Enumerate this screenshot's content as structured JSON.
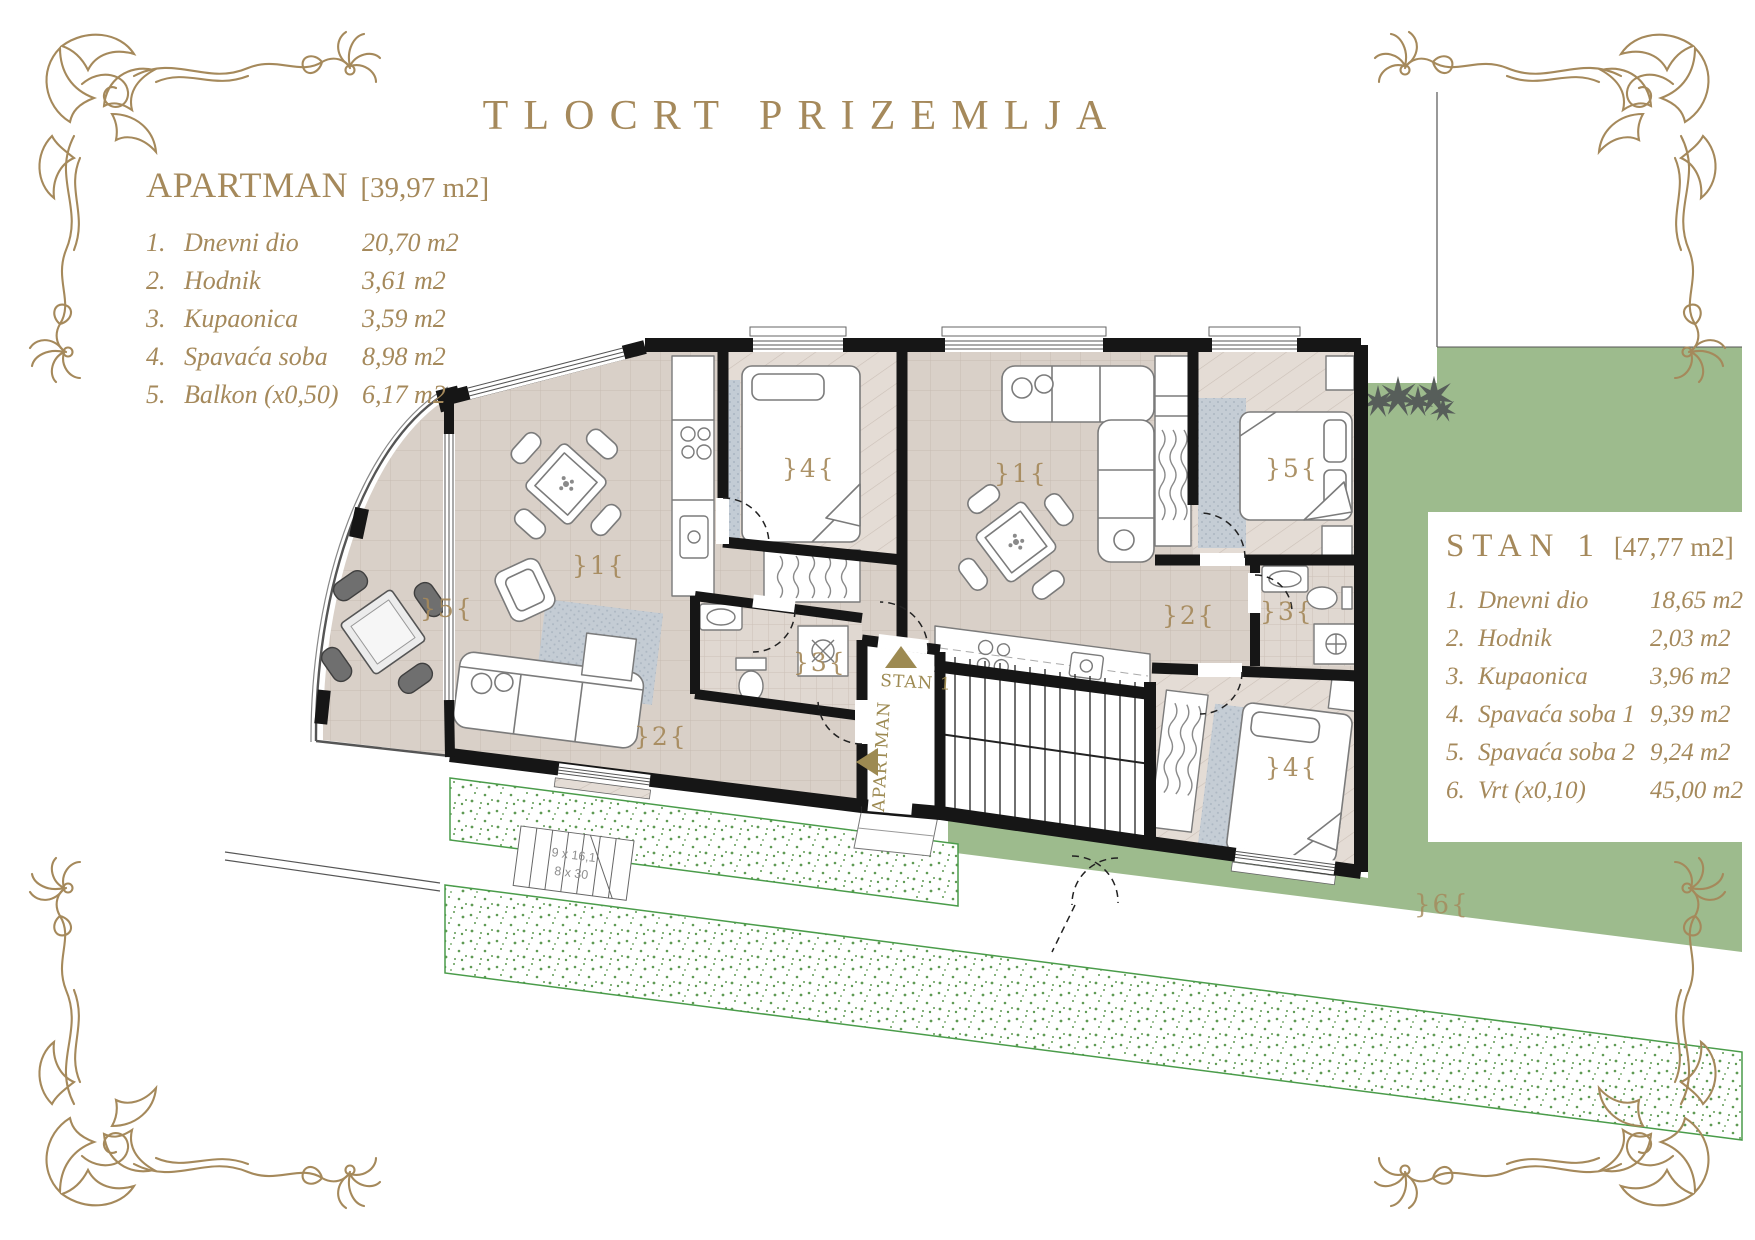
{
  "title": "TLOCRT PRIZEMLJA",
  "legend_apartman": {
    "name": "APARTMAN",
    "area": "[39,97 m2]",
    "rows": [
      {
        "num": "1.",
        "label": "Dnevni dio",
        "value": "20,70 m2"
      },
      {
        "num": "2.",
        "label": "Hodnik",
        "value": "3,61 m2"
      },
      {
        "num": "3.",
        "label": "Kupaonica",
        "value": "3,59 m2"
      },
      {
        "num": "4.",
        "label": "Spavaća soba",
        "value": "8,98 m2"
      },
      {
        "num": "5.",
        "label": "Balkon (x0,50)",
        "value": "6,17 m2"
      }
    ]
  },
  "legend_stan1": {
    "name": "STAN 1",
    "area": "[47,77 m2]",
    "rows": [
      {
        "num": "1.",
        "label": "Dnevni dio",
        "value": "18,65 m2"
      },
      {
        "num": "2.",
        "label": "Hodnik",
        "value": "2,03 m2"
      },
      {
        "num": "3.",
        "label": "Kupaonica",
        "value": "3,96 m2"
      },
      {
        "num": "4.",
        "label": "Spavaća soba 1",
        "value": "9,39 m2"
      },
      {
        "num": "5.",
        "label": "Spavaća soba 2",
        "value": "9,24 m2"
      },
      {
        "num": "6.",
        "label": "Vrt (x0,10)",
        "value": "45,00 m2"
      }
    ]
  },
  "plan": {
    "apartman_labels": {
      "living": "}1{",
      "hall": "}2{",
      "bath": "}3{",
      "bedroom": "}4{",
      "balcony": "}5{"
    },
    "stan1_labels": {
      "living": "}1{",
      "hall": "}2{",
      "bath": "}3{",
      "bedroom1": "}4{",
      "bedroom2": "}5{",
      "garden": "}6{"
    },
    "entry": {
      "stan1": "STAN 1",
      "apartman": "APARTMAN"
    },
    "exterior_stair": {
      "line1": "9 x 16,1",
      "line2": "8 x 30"
    }
  },
  "colors": {
    "gold": "#A5895B",
    "wall": "#161616",
    "floor": "#D9D0C8",
    "garden": "#9DBB8D"
  }
}
